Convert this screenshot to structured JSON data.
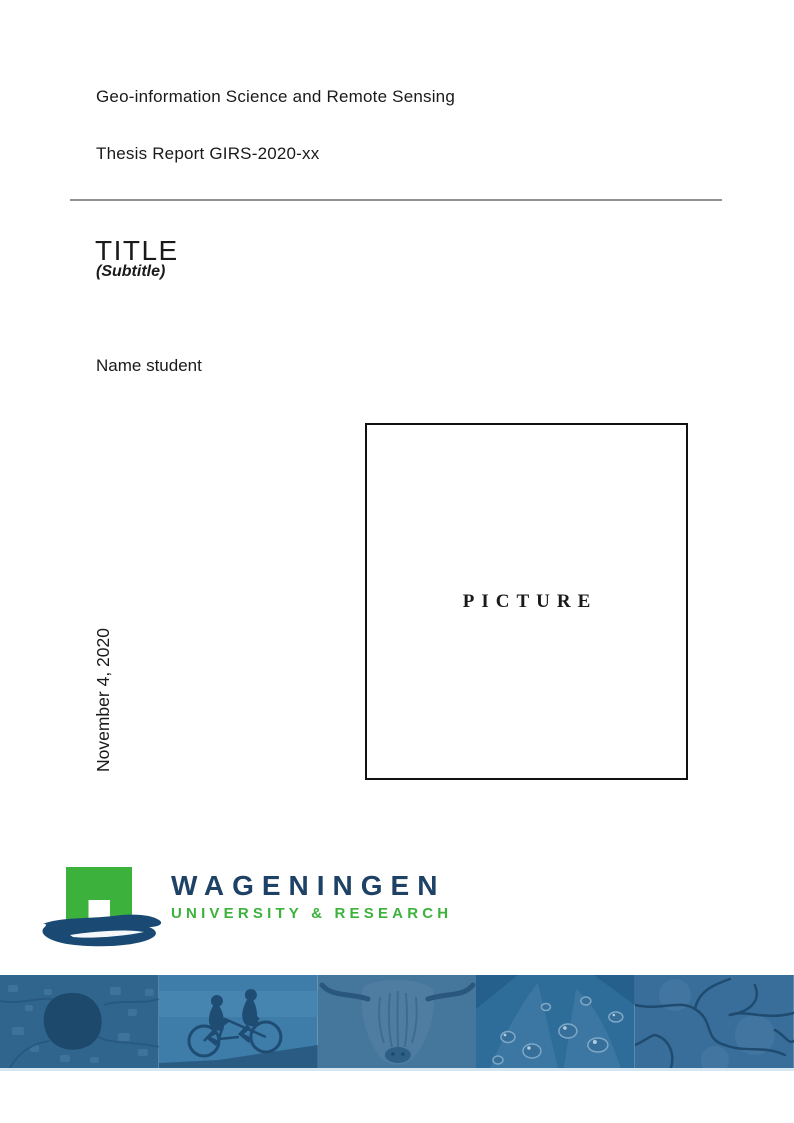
{
  "document": {
    "program": "Geo-information Science and Remote Sensing",
    "report": "Thesis Report GIRS-2020-xx",
    "title": "TITLE",
    "subtitle": "(Subtitle)",
    "author": "Name student",
    "date": "November 4, 2020",
    "picture_placeholder": "PICTURE"
  },
  "logo": {
    "wordmark": "WAGENINGEN",
    "tagline": "UNIVERSITY & RESEARCH",
    "mark": "wageningen-arch-brush-logo",
    "colors": {
      "green": "#3CB23C",
      "wordmark_navy": "#1E4265",
      "brush_navy": "#1A4A74"
    }
  },
  "banner": {
    "tint": "#33688F",
    "images": [
      {
        "name": "aerial-map-photo"
      },
      {
        "name": "tandem-cyclists-photo"
      },
      {
        "name": "highland-cow-photo"
      },
      {
        "name": "water-droplets-leaf-photo"
      },
      {
        "name": "cracked-earth-photo"
      }
    ]
  }
}
